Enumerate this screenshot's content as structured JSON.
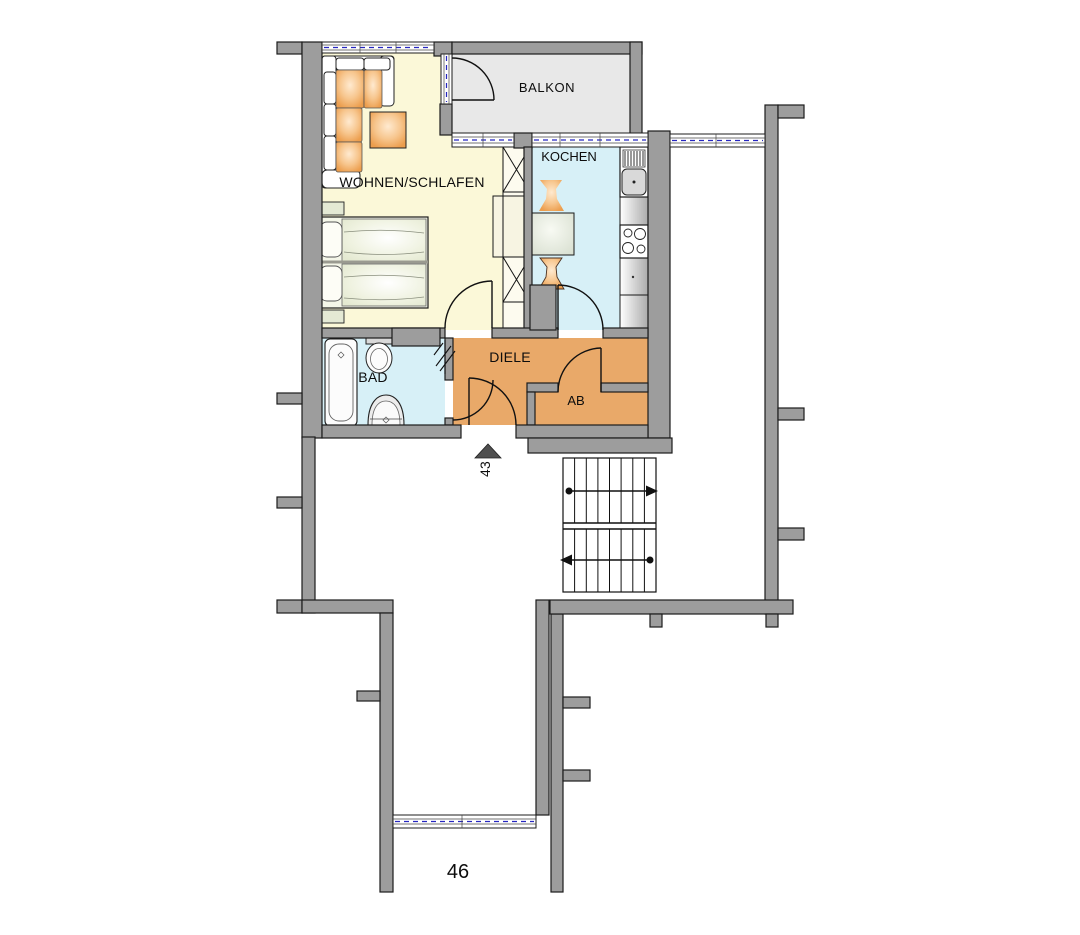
{
  "floorplan": {
    "rooms": [
      {
        "id": "wohnen_schlafen",
        "label": "WOHNEN/SCHLAFEN"
      },
      {
        "id": "balkon",
        "label": "BALKON"
      },
      {
        "id": "kochen",
        "label": "KOCHEN"
      },
      {
        "id": "bad",
        "label": "BAD"
      },
      {
        "id": "diele",
        "label": "DIELE"
      },
      {
        "id": "ab",
        "label": "AB"
      }
    ],
    "apartment_number": "43",
    "adjacent_unit_number": "46",
    "stairs": {
      "flights": 2,
      "upper_arrow_direction": "right",
      "lower_arrow_direction": "left"
    },
    "colors": {
      "wall": "#9D9D9D",
      "living_floor": "#FBF8D8",
      "kitchen_floor": "#D7F0F7",
      "bath_floor": "#D7F0F7",
      "hall_floor": "#E9A969",
      "balcony_floor": "#E8E8E8",
      "window_glazing": "#2626C0",
      "furniture_orange": "#EFA358",
      "entrance_marker": "#4F4F4F"
    }
  }
}
